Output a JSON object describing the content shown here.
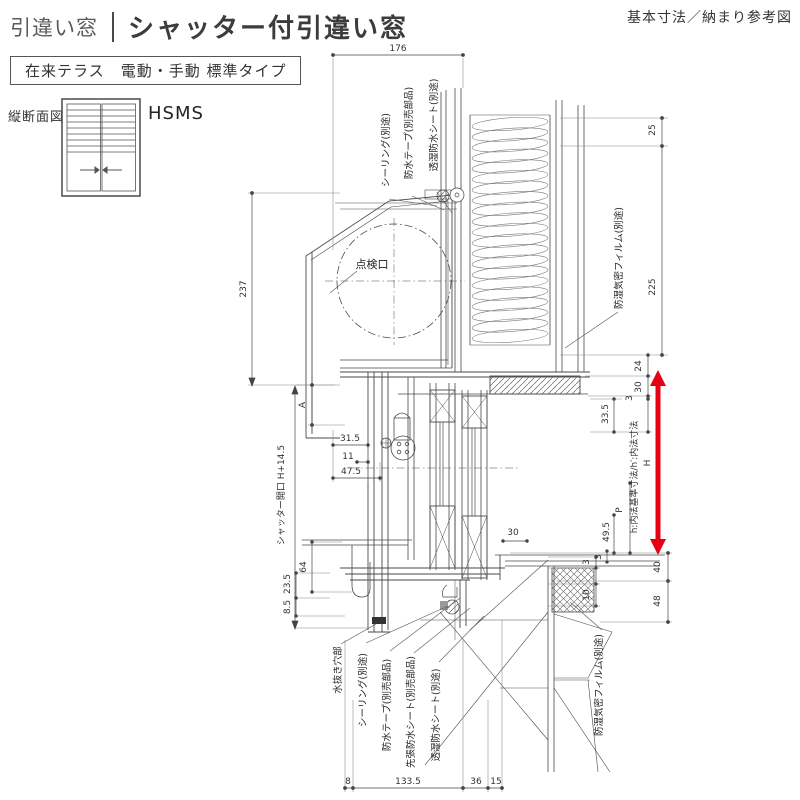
{
  "header": {
    "category": "引違い窓",
    "title": "シャッター付引違い窓",
    "corner_note": "基本寸法／納まり参考図",
    "type_label": "在来テラス　電動・手動 標準タイプ",
    "section_view_label": "縦断面図",
    "model_code": "HSMS"
  },
  "colors": {
    "line": "#4a4a4a",
    "dim_text": "#333333",
    "accent_red": "#e60012"
  },
  "drawing": {
    "inspection_port": "点検口",
    "shutter_opening": "シャッター開口 H+14.5",
    "inner_dim_note": "h:内法基準寸法/h′:内法寸法",
    "callouts_top": [
      "シーリング(別途)",
      "防水テープ(別売部品)",
      "透湿防水シート(別途)"
    ],
    "callout_right": "防湿気密フィルム(別途)",
    "callout_bottom_right": "防湿気密フィルム(別途)",
    "callouts_bottom": [
      "水抜き穴部",
      "シーリング(別途)",
      "防水テープ(別売部品)",
      "先張防水シート(別売部品)",
      "透湿防水シート(別途)"
    ],
    "dims": {
      "top_width": "176",
      "box_height": "237",
      "a": "A",
      "d31_5": "31.5",
      "d11": "11",
      "d47_5": "47.5",
      "r25": "25",
      "r225": "225",
      "r24": "24",
      "r30": "30",
      "r3a": "3",
      "r33_5": "33.5",
      "H": "H",
      "P": "P",
      "r49_5": "49.5",
      "r3b": "3",
      "r40": "40",
      "r48": "48",
      "r3c": "3",
      "r10": "10",
      "w30": "30",
      "l64": "64",
      "l23_5": "23.5",
      "l8_5": "8.5",
      "b8": "8",
      "b133_5": "133.5",
      "b36": "36",
      "b15": "15"
    }
  }
}
